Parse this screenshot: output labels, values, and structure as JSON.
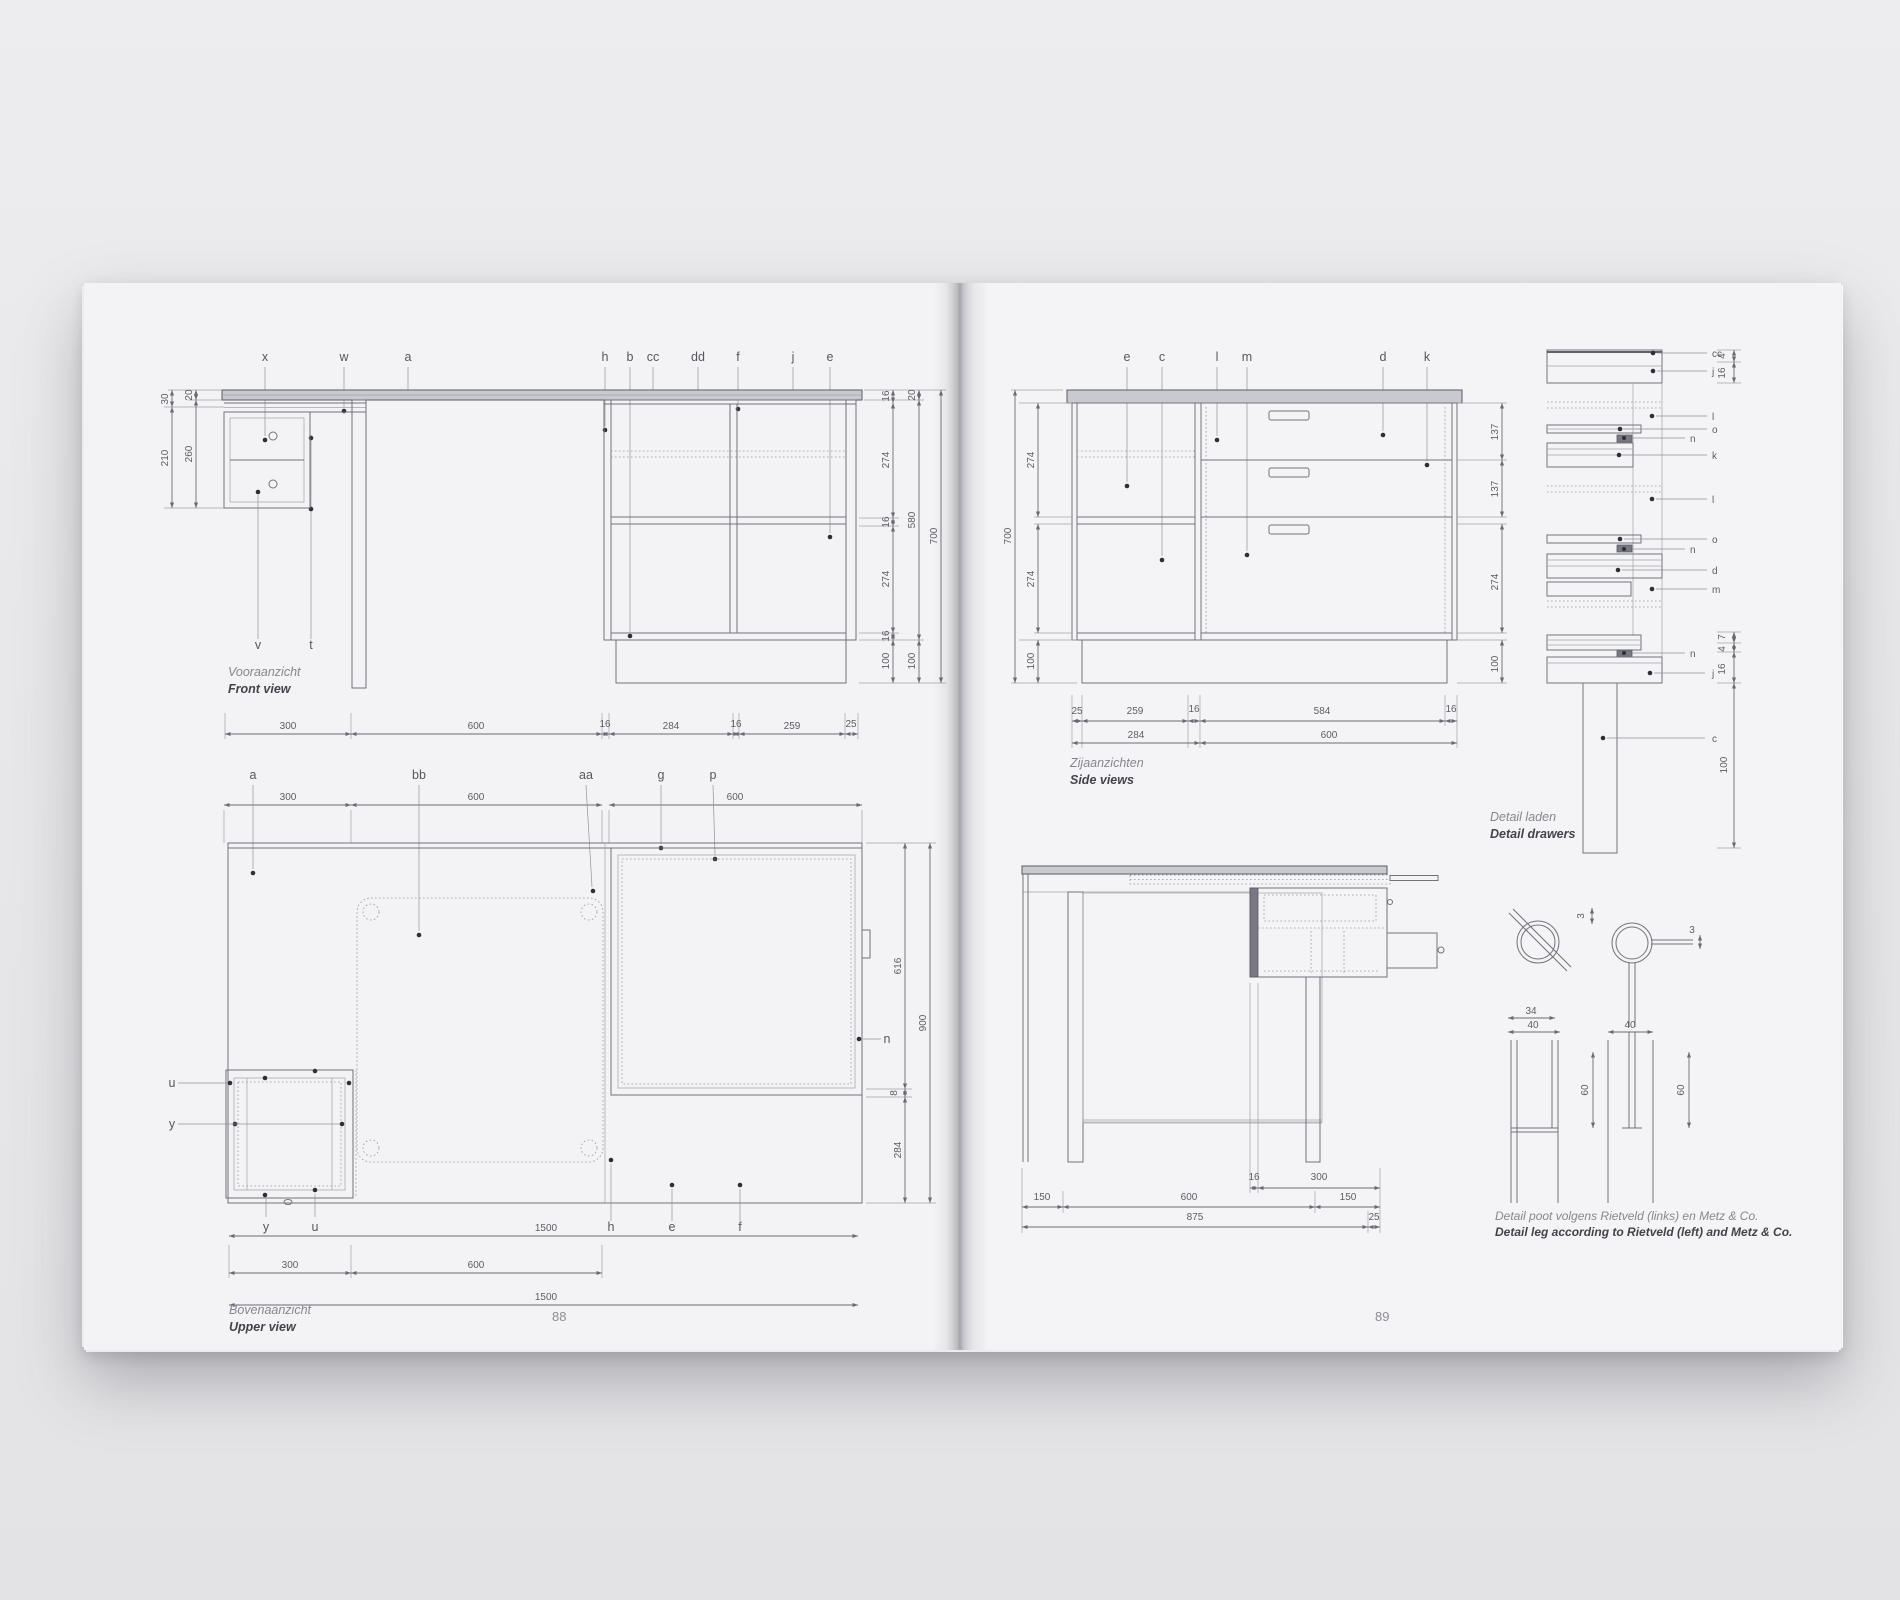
{
  "book": {
    "left_page": {
      "page_number": "88",
      "front_view": {
        "caption_nl": "Vooraanzicht",
        "caption_en": "Front view",
        "labels": {
          "x": "x",
          "w": "w",
          "a": "a",
          "h": "h",
          "b": "b",
          "cc": "cc",
          "dd": "dd",
          "f": "f",
          "j": "j",
          "e": "e",
          "v": "v",
          "t": "t"
        },
        "dims": {
          "d30": "30",
          "d20": "20",
          "d210": "210",
          "d260": "260",
          "r16a": "16",
          "r274a": "274",
          "r16b": "16",
          "r274b": "274",
          "r16c": "16",
          "r100a": "100",
          "m20": "20",
          "m580": "580",
          "m100": "100",
          "o700": "700",
          "b300": "300",
          "b600": "600",
          "b16a": "16",
          "b284": "284",
          "b16b": "16",
          "b259": "259",
          "b25": "25"
        }
      },
      "upper_view": {
        "caption_nl": "Bovenaanzicht",
        "caption_en": "Upper view",
        "labels": {
          "a": "a",
          "bb": "bb",
          "aa": "aa",
          "g": "g",
          "p": "p",
          "u": "u",
          "y": "y",
          "y2": "y",
          "u2": "u",
          "h": "h",
          "e": "e",
          "f": "f",
          "n": "n"
        },
        "dims": {
          "t300": "300",
          "t600a": "600",
          "t600b": "600",
          "r616": "616",
          "r8": "8",
          "r284": "284",
          "r900": "900",
          "b1500a": "1500",
          "b300": "300",
          "b600": "600",
          "b1500b": "1500"
        }
      }
    },
    "right_page": {
      "page_number": "89",
      "side_views": {
        "caption_nl": "Zijaanzichten",
        "caption_en": "Side views",
        "labels": {
          "e": "e",
          "c": "c",
          "l": "l",
          "m": "m",
          "d": "d",
          "k": "k"
        },
        "dims": {
          "l700": "700",
          "l274a": "274",
          "l274b": "274",
          "l100": "100",
          "r137a": "137",
          "r137b": "137",
          "r274": "274",
          "r100": "100",
          "b25": "25",
          "b259": "259",
          "b16a": "16",
          "b584": "584",
          "b16b": "16",
          "b284": "284",
          "b600": "600"
        }
      },
      "desk_side_view": {
        "dims": {
          "t16": "16",
          "t300": "300",
          "m150a": "150",
          "m600": "600",
          "m150b": "150",
          "b875": "875",
          "b25": "25"
        }
      },
      "detail_drawers": {
        "caption_nl": "Detail laden",
        "caption_en": "Detail drawers",
        "labels": {
          "cc": "cc",
          "j1": "j",
          "l1": "l",
          "o1": "o",
          "n1": "n",
          "k": "k",
          "l2": "l",
          "o2": "o",
          "n2": "n",
          "d": "d",
          "m": "m",
          "n3": "n",
          "j2": "j",
          "c": "c"
        },
        "dims": {
          "d4a": "4",
          "d16a": "16",
          "d7": "7",
          "d4b": "4",
          "d16b": "16",
          "d100": "100"
        }
      },
      "leg_detail": {
        "caption_nl": "Detail poot volgens Rietveld (links) en Metz & Co.",
        "caption_en": "Detail leg according to Rietveld (left) and Metz & Co.",
        "dims": {
          "c3a": "3",
          "c3b": "3",
          "w34": "34",
          "w40a": "40",
          "w40b": "40",
          "h60a": "60",
          "h60b": "60"
        }
      }
    }
  }
}
